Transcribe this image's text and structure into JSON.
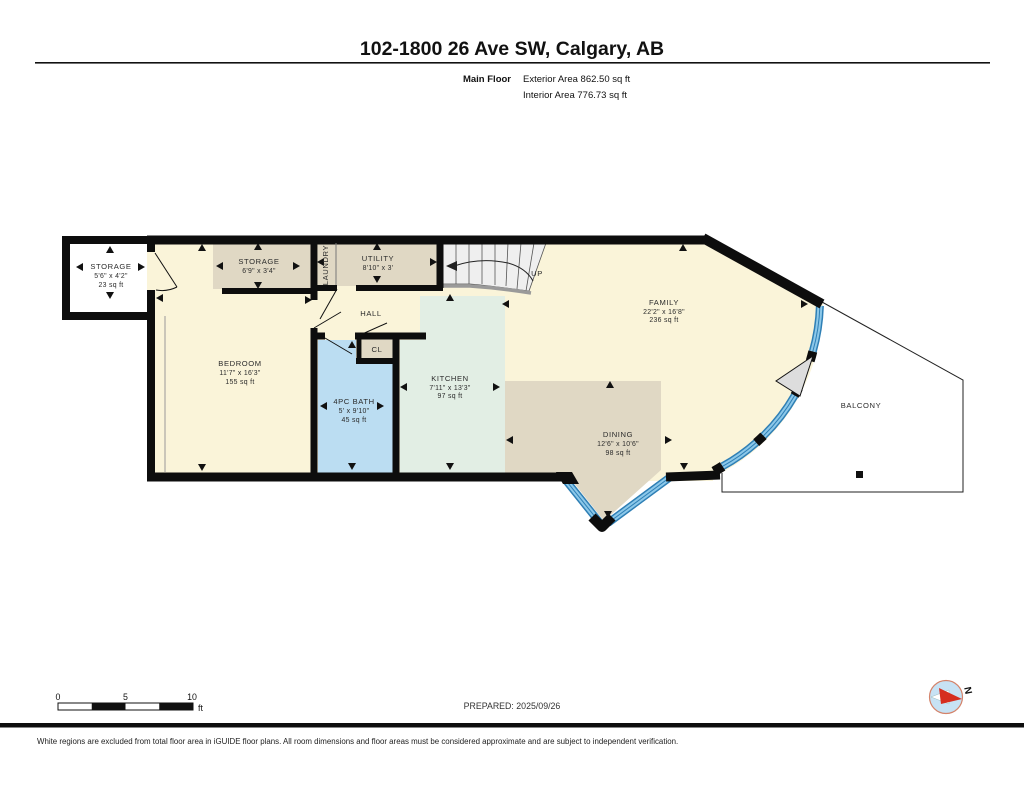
{
  "header": {
    "title": "102-1800 26 Ave SW, Calgary, AB",
    "floor_label": "Main Floor",
    "exterior_area": "Exterior Area 862.50 sq ft",
    "interior_area": "Interior Area 776.73 sq ft"
  },
  "rooms": {
    "storage_annex": {
      "name": "STORAGE",
      "dims": "5'6\" x 4'2\"",
      "area": "23 sq ft"
    },
    "storage": {
      "name": "STORAGE",
      "dims": "6'9\" x 3'4\""
    },
    "laundry": {
      "name": "LAUNDRY"
    },
    "utility": {
      "name": "UTILITY",
      "dims": "8'10\" x 3'"
    },
    "hall": {
      "name": "HALL"
    },
    "closet": {
      "name": "CL"
    },
    "bedroom": {
      "name": "BEDROOM",
      "dims": "11'7\" x 16'3\"",
      "area": "155 sq ft"
    },
    "bath": {
      "name": "4PC BATH",
      "dims": "5' x 9'10\"",
      "area": "45 sq ft"
    },
    "kitchen": {
      "name": "KITCHEN",
      "dims": "7'11\" x 13'3\"",
      "area": "97 sq ft"
    },
    "dining": {
      "name": "DINING",
      "dims": "12'6\" x 10'6\"",
      "area": "98 sq ft"
    },
    "family": {
      "name": "FAMILY",
      "dims": "22'2\" x 16'8\"",
      "area": "236 sq ft"
    },
    "balcony": {
      "name": "BALCONY"
    }
  },
  "stairs": {
    "label": "UP"
  },
  "compass": {
    "north_label": "N"
  },
  "scale_bar": {
    "tick0": "0",
    "tick1": "5",
    "tick2": "10",
    "unit": "ft"
  },
  "footer": {
    "prepared": "PREPARED: 2025/09/26",
    "disclaimer": "White regions are excluded from total floor area in iGUIDE floor plans. All room dimensions and floor areas must be considered approximate and are subject to independent verification."
  },
  "colors": {
    "wall": "#0d0d0d",
    "room_cream": "#FAF4D9",
    "room_tan": "#E0D8C4",
    "room_mint": "#E2EEE4",
    "room_blue": "#BBDDF2",
    "window_dark": "#2E7FB5",
    "window_light": "#8CC8E9",
    "stair_fill": "#EFEFEF",
    "compass_blue": "#C7E2F4",
    "compass_red": "#D62E1F"
  }
}
